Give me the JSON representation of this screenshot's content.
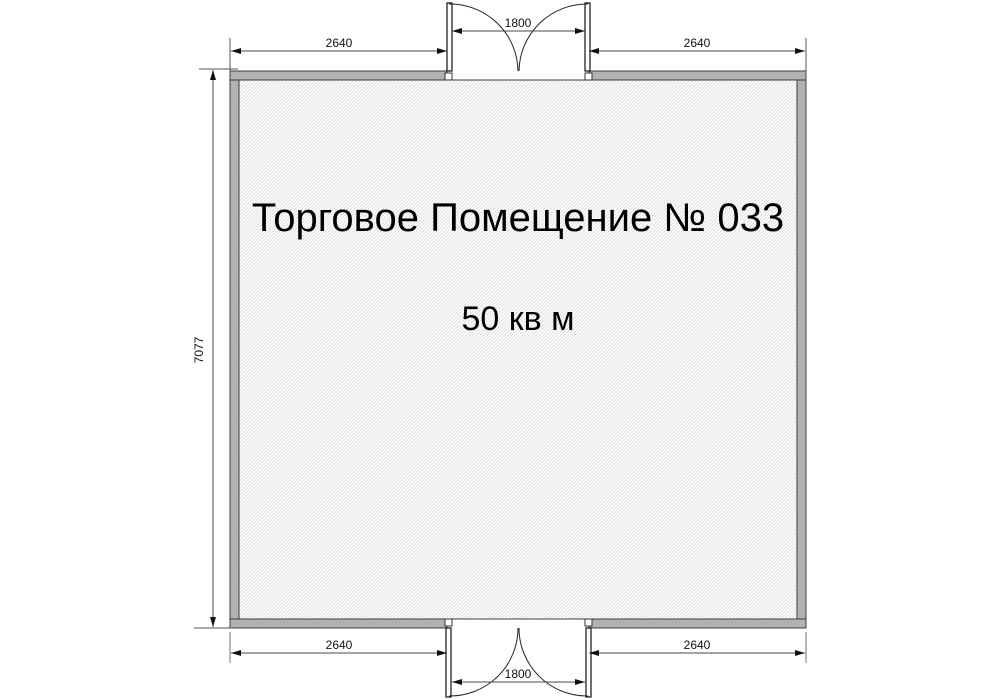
{
  "plan": {
    "room_label": "Торговое Помещение № 033",
    "room_area": "50 кв м",
    "dims": {
      "top_left_width": "2640",
      "top_door_width": "1800",
      "top_right_width": "2640",
      "left_height": "7077",
      "bottom_left_width": "2640",
      "bottom_door_width": "1800",
      "bottom_right_width": "2640"
    },
    "colors": {
      "wall_fill": "#b2b2b2",
      "wall_outline": "#3c3c3c",
      "hatch_line": "#d3dbd1",
      "dimension_line": "#4a4a4a",
      "extension_line": "#9a9a9a",
      "text": "#000000",
      "background": "#ffffff"
    }
  }
}
